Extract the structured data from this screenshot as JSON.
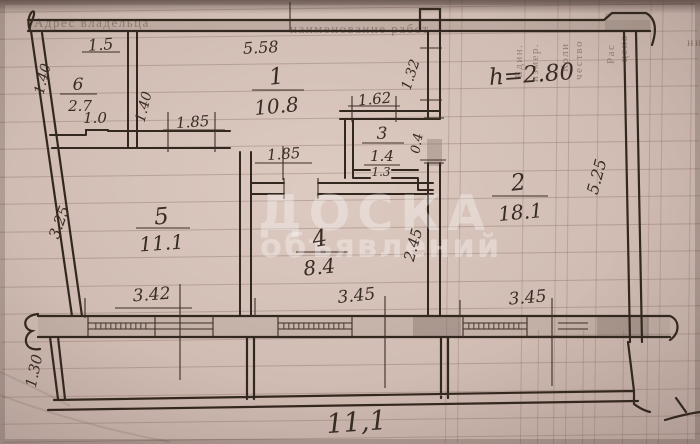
{
  "watermark": {
    "line1": "ДОСКА",
    "line2": "объявлений"
  },
  "paper_print": {
    "top_left": "Адрес владельца",
    "top_center": "наименование работ",
    "col_unit_1": "Един.",
    "col_unit_2": "измер.",
    "col_qty_1": "Коли",
    "col_qty_2": "чество",
    "col_price_1": "Рас",
    "col_price_2": "цена",
    "right_edge": "ни"
  },
  "plan": {
    "height_note": "h=2.80",
    "rooms": [
      {
        "id": "1",
        "area": "10.8"
      },
      {
        "id": "2",
        "area": "18.1"
      },
      {
        "id": "3",
        "area": "1.4",
        "sub": "1.3"
      },
      {
        "id": "4",
        "area": "8.4"
      },
      {
        "id": "5",
        "area": "11.1"
      },
      {
        "id": "6",
        "area": "2.7"
      }
    ],
    "dims": {
      "top_left": "1.5",
      "top_center": "5.58",
      "left_upper": "1.40",
      "closet_right": "1.40",
      "closet_width": "1.85",
      "closet_inner": "1.0",
      "wc_top": "1.62",
      "wall_upper": "1.32",
      "hall_width": "1.85",
      "wc_door": "0.4",
      "right_side": "5.25",
      "left_side": "3.25",
      "room4_side": "2.45",
      "bottom_left": "3.42",
      "bottom_mid": "3.45",
      "bottom_right": "3.45",
      "loggia_depth": "1.30",
      "loggia_length": "11,1"
    }
  },
  "colors": {
    "paper": "#d3c0b7",
    "ink": "#372c25",
    "watermark": "rgba(255,255,255,0.33)"
  }
}
